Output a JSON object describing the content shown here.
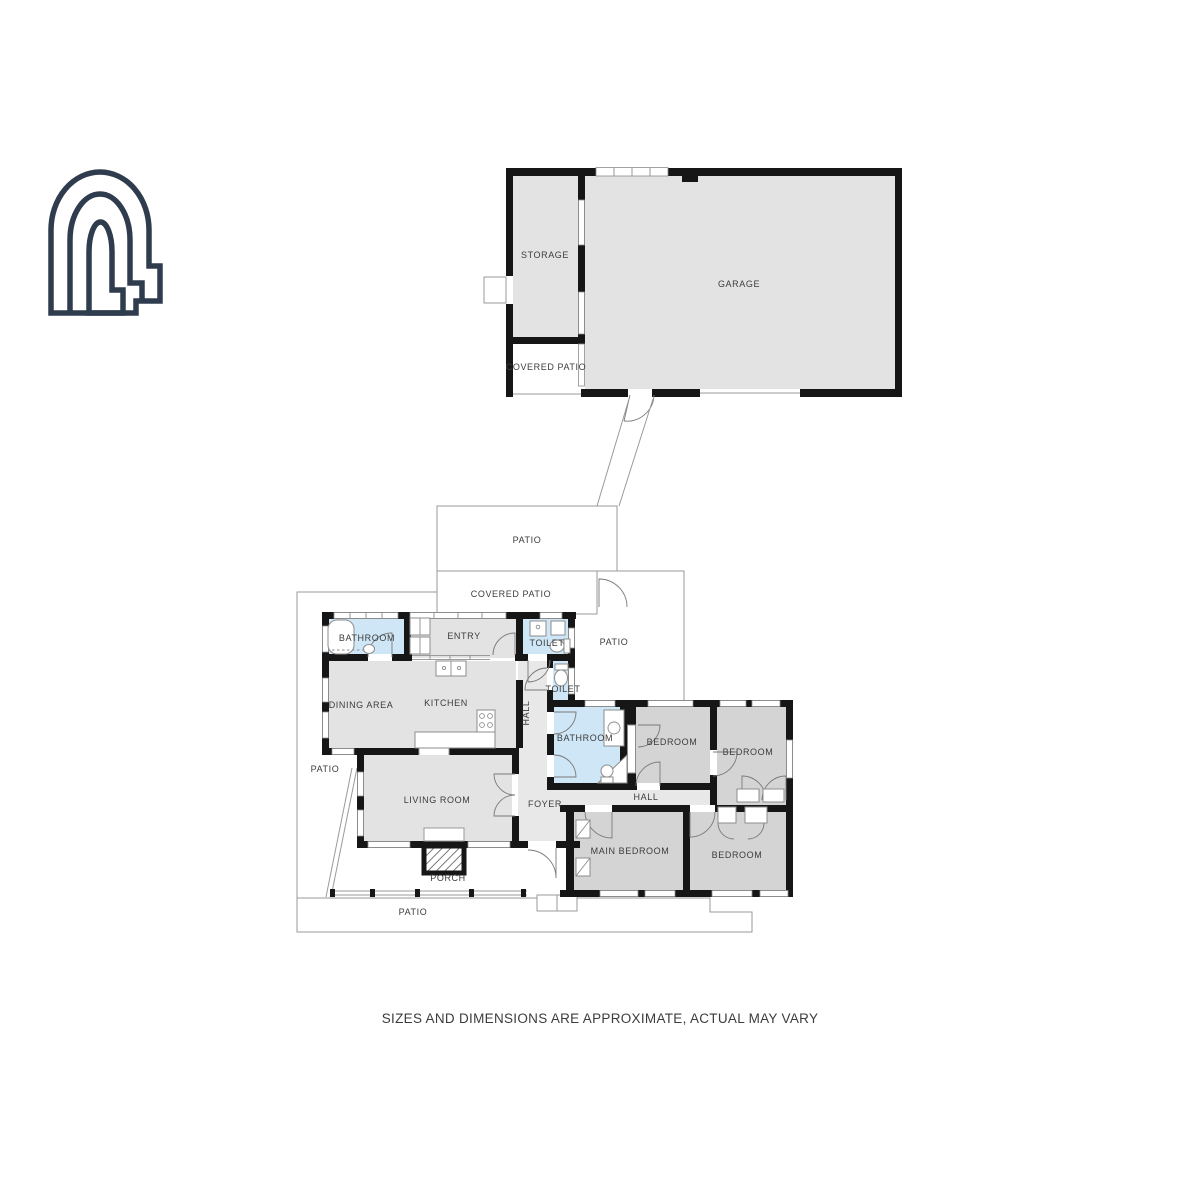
{
  "brand": {
    "logo_icon": "arch-logo",
    "logo_color": "#2e3c4e"
  },
  "floorplan": {
    "labels": {
      "storage": "STORAGE",
      "garage": "GARAGE",
      "covered_patio_garage": "COVERED PATIO",
      "patio_upper": "PATIO",
      "covered_patio_house": "COVERED PATIO",
      "patio_right": "PATIO",
      "patio_left": "PATIO",
      "patio_bottom": "PATIO",
      "bathroom_front": "BATHROOM",
      "entry": "ENTRY",
      "toilet_front": "TOILET",
      "dining_area": "DINING AREA",
      "kitchen": "KITCHEN",
      "hall_upper": "HALL",
      "toilet_rear": "TOILET",
      "bathroom_rear": "BATHROOM",
      "bedroom_mid_left": "BEDROOM",
      "bedroom_mid_right": "BEDROOM",
      "hall_rear": "HALL",
      "living_room": "LIVING ROOM",
      "foyer": "FOYER",
      "main_bedroom": "MAIN BEDROOM",
      "bedroom_rear": "BEDROOM",
      "porch": "PORCH"
    },
    "colors": {
      "room_fill": "#e3e3e3",
      "bedroom_fill": "#d4d4d4",
      "bathroom_fill": "#cee6f6",
      "hallway_fill": "#e8e8e8",
      "wall": "#161616",
      "outline": "#9a9a9a",
      "fixture": "#8c8c8c",
      "label": "#3c3c3c",
      "logo": "#2e3c4e"
    }
  },
  "footer": {
    "disclaimer": "SIZES AND DIMENSIONS ARE APPROXIMATE, ACTUAL MAY VARY"
  }
}
